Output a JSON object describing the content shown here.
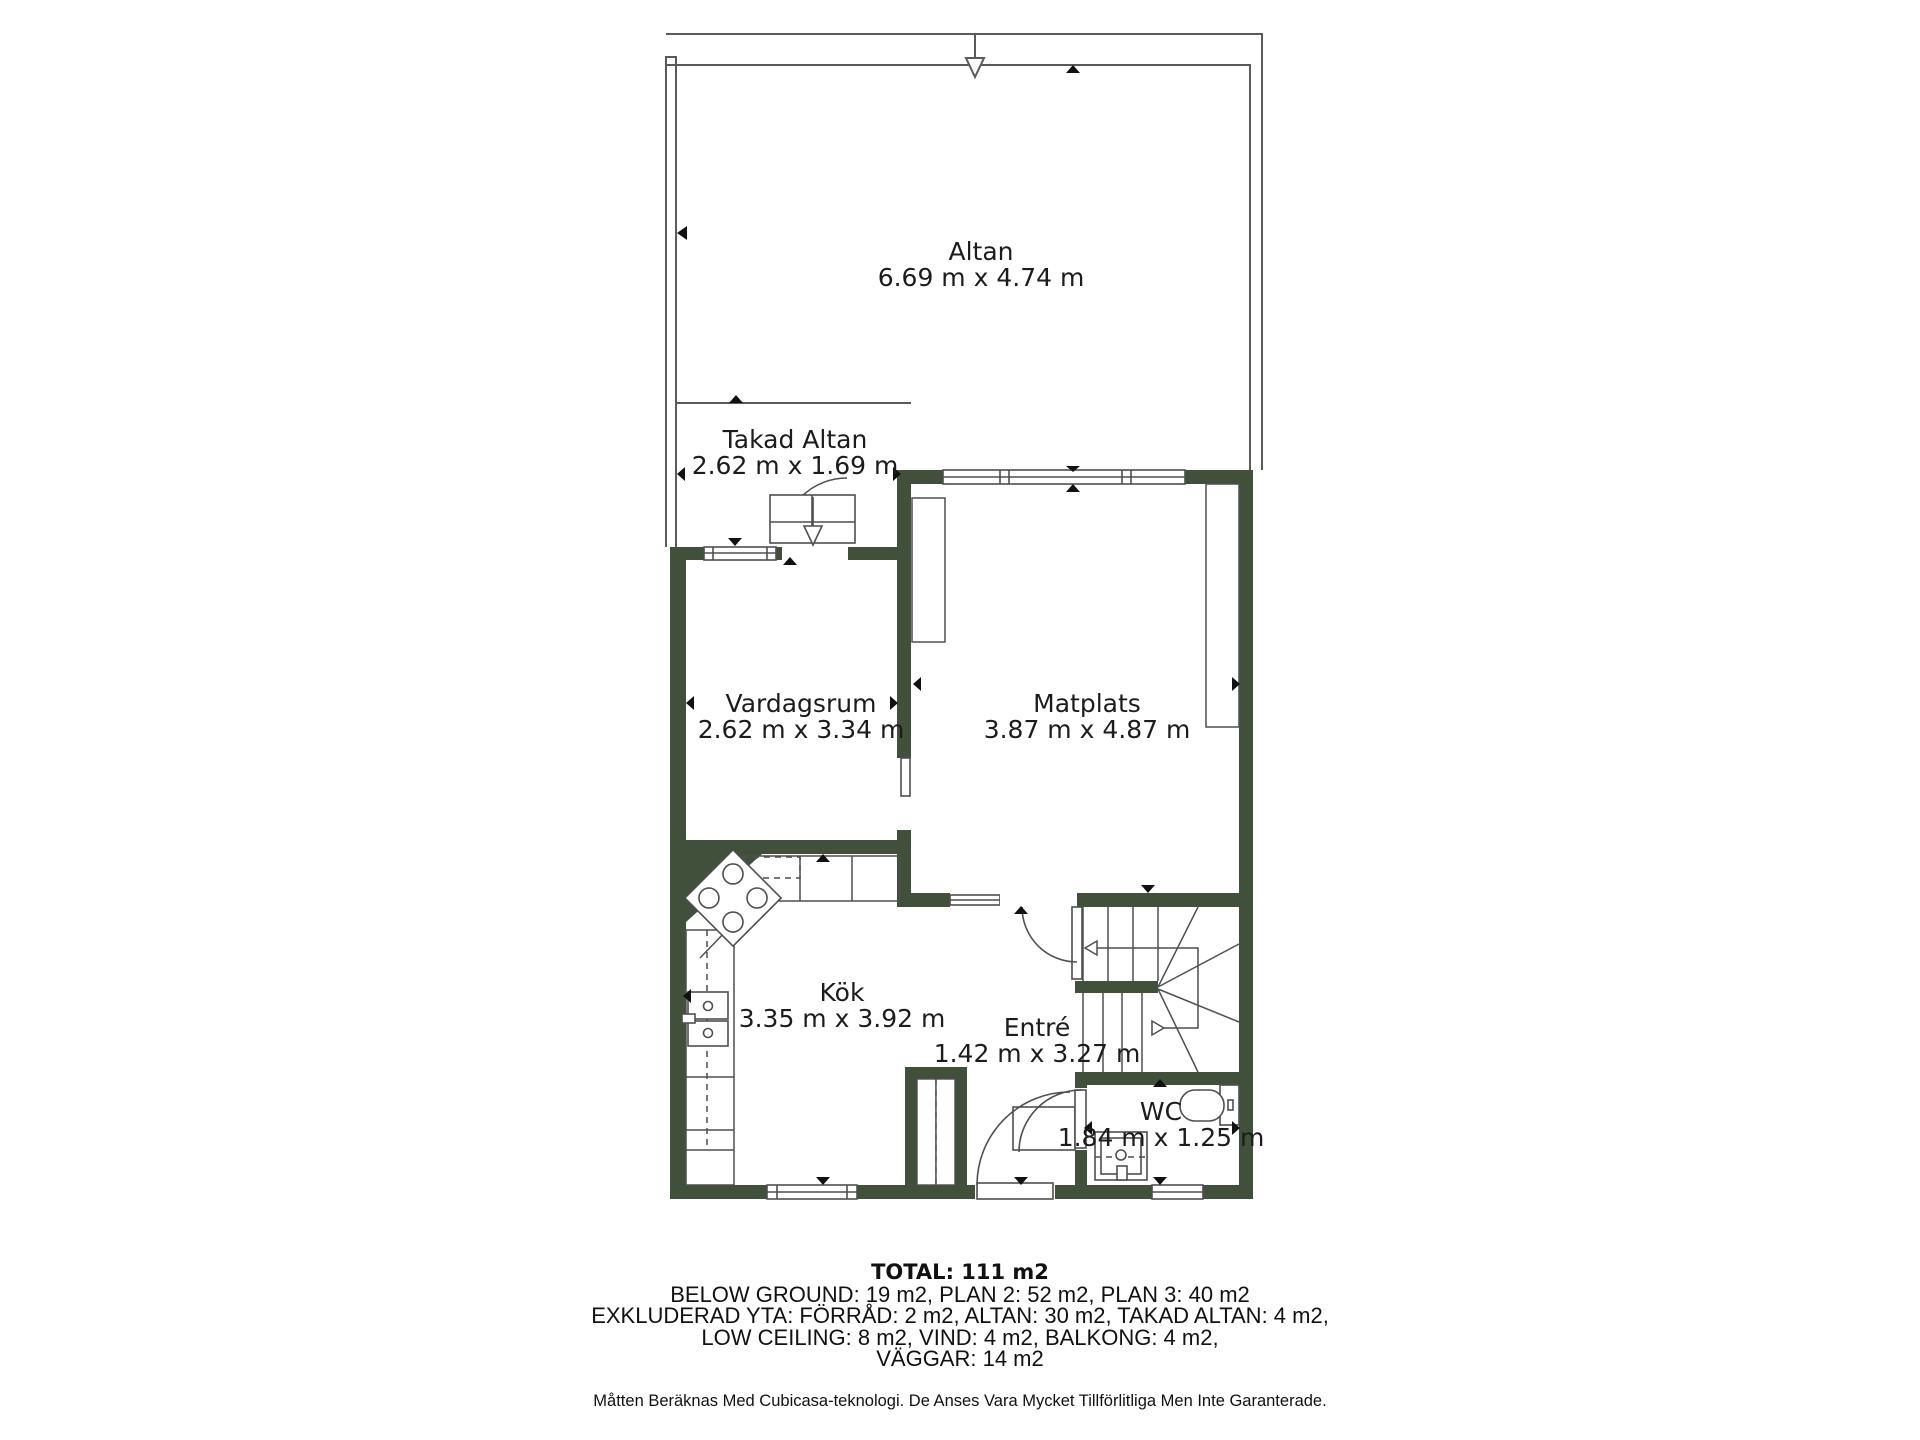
{
  "rooms": [
    {
      "name": "Altan",
      "dims": "6.69 m x 4.74 m"
    },
    {
      "name": "Takad Altan",
      "dims": "2.62 m x 1.69 m"
    },
    {
      "name": "Vardagsrum",
      "dims": "2.62 m x 3.34 m"
    },
    {
      "name": "Matplats",
      "dims": "3.87 m x 4.87 m"
    },
    {
      "name": "Kök",
      "dims": "3.35 m x 3.92 m"
    },
    {
      "name": "Entré",
      "dims": "1.42 m x 3.27 m"
    },
    {
      "name": "WC",
      "dims": "1.84 m x 1.25 m"
    }
  ],
  "title_block": {
    "total": "TOTAL: 111 m2",
    "lines": [
      "BELOW GROUND: 19 m2, PLAN 2: 52 m2, PLAN 3: 40 m2",
      "EXKLUDERAD YTA: FÖRRÅD: 2 m2, ALTAN: 30 m2, TAKAD ALTAN: 4 m2,",
      "LOW CEILING: 8 m2, VIND: 4 m2, BALKONG: 4 m2,",
      "VÄGGAR: 14 m2"
    ],
    "disclaimer": "Måtten Beräknas Med Cubicasa-teknologi. De Anses Vara Mycket Tillförlitliga Men Inte Garanterade."
  },
  "colors": {
    "wall": "#40503a",
    "line": "#4f4f4f",
    "text": "#1c1c1c"
  }
}
